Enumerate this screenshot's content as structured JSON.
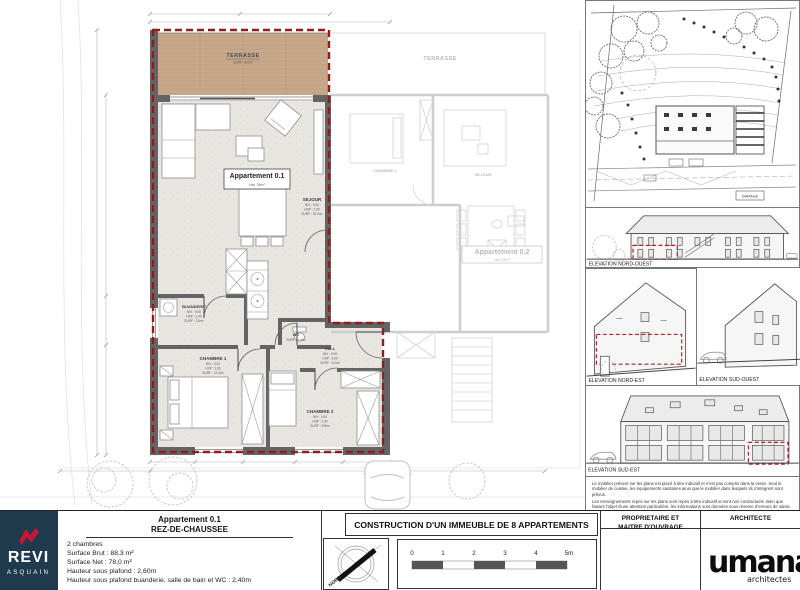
{
  "plan": {
    "apartment_box": {
      "title": "Appartement 0.1",
      "sub": "Net 78m²"
    },
    "rooms": {
      "terrasse": {
        "name": "TERRASSE",
        "surf": "SURF : 8.0m²"
      },
      "sejour": {
        "name": "SEJOUR",
        "niv": "NIV : 0.00",
        "hsp": "HSP : 2.60",
        "surf": "SURF : 32.2m²"
      },
      "buanderie": {
        "name": "BUANDERIE",
        "niv": "NIV : 0.00",
        "hsp": "HSP : 2.40",
        "surf": "SURF : 2.6m²"
      },
      "wc": {
        "name": "WC",
        "surf": "SURF : 1.3m²"
      },
      "hall": {
        "name": "HALL",
        "niv": "NIV : 0.00",
        "hsp": "HSP : 2.60",
        "surf": "SURF : 5.0m²"
      },
      "chambre1": {
        "name": "CHAMBRE 1",
        "niv": "NIV : 0.00",
        "hsp": "HSP : 2.60",
        "surf": "SURF : 12.4m²"
      },
      "chambre2": {
        "name": "CHAMBRE 2",
        "niv": "NIV : 0.00",
        "hsp": "HSP : 2.60",
        "surf": "SURF : 9.8m²"
      }
    },
    "neighbor": {
      "terrasse": "TERRASSE",
      "chambre1": "CHAMBRE 1",
      "sejour": "SEJOUR",
      "apartment": "Appartement 0.2"
    }
  },
  "sheet": {
    "site": {
      "garage": "GARAGE"
    },
    "elevations": [
      "ELEVATION NORD-OUEST",
      "ELEVATION NORD-EST",
      "ELEVATION SUD-OUEST",
      "ELEVATION SUD-EST"
    ],
    "disclaimer1": "Le mobilier présent sur les plans est placé à titre indicatif et n'est pas compris dans la vente. Seul le mobilier de cuisine, les équipements sanitaires ainsi que le mobilier dans lesquels ils s'intègrent sont prévus.",
    "disclaimer2": "Les renseignements repris sur les plans sont repris à titre indicatif et sont non contractuels. Bien que faisant l'objet d'une attention particulière, les informations sont données sous réserve d'erreurs de saisie et/ou de modifications éventuelles."
  },
  "titleblock": {
    "logo": {
      "line1": "REVI",
      "line2": "ASQUAIN"
    },
    "apartment": {
      "title": "Appartement 0.1",
      "subtitle": "REZ-DE-CHAUSSEE",
      "lines": [
        "2 chambres",
        "Surface Brut : 88,3 m²",
        "Surface Net : 78,0 m²",
        "Hauteur sous plafond : 2,60m",
        "Hauteur sous plafond buanderie, salle de bain et WC : 2,40m"
      ]
    },
    "project_title": "CONSTRUCTION D'UN IMMEUBLE DE 8 APPARTEMENTS",
    "compass_north": "NORD",
    "scale_ticks": [
      "0",
      "1",
      "2",
      "3",
      "4",
      "5m"
    ],
    "owner_header1": "PROPRIETAIRE ET",
    "owner_header2": "MAITRE D'OUVRAGE",
    "architect_header": "ARCHITECTE",
    "architect_logo": {
      "name": "umana",
      "sub": "architectes"
    }
  },
  "colors": {
    "boundary_red": "#8e1e1e",
    "logo_navy": "#1e3a4c",
    "logo_red": "#c41735",
    "terrace_wood": "#c9ab8d"
  }
}
